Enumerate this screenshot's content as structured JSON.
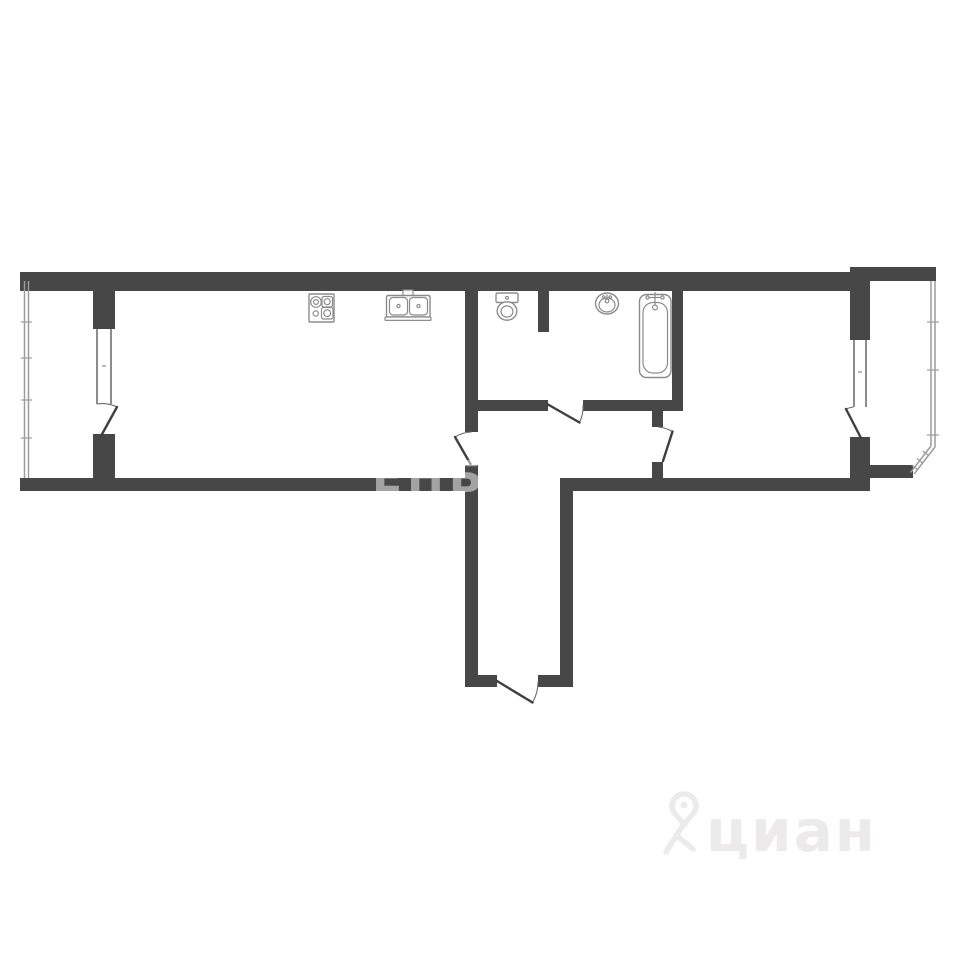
{
  "colors": {
    "background": "#ffffff",
    "wall_color": "#474747",
    "window_color": "#6f6f6f",
    "glazing_color": "#9c9c9c",
    "door_color": "#3f3f3f",
    "arc_color": "#6a6a6a",
    "fixture_color": "#8b8b8b",
    "wm_center_color": "rgba(255,255,255,0.5)",
    "wm_brand_color": "#eceaea"
  },
  "watermark": {
    "center_text": "ЕНБ",
    "brand_text": "циан",
    "logo": "cian-pin-person-logo"
  },
  "floor_plan": {
    "type": "apartment-linear-floor-plan",
    "rooms": [
      "left-loggia",
      "kitchen-living-room",
      "bathroom-wc",
      "hallway",
      "entrance-corridor",
      "bedroom",
      "right-loggia-bay"
    ],
    "fixtures": [
      "stove-4-burner",
      "double-bowl-sink",
      "toilet",
      "washbasin",
      "bathtub"
    ],
    "doors": [
      "left-balcony-door",
      "kitchen-door",
      "bathroom-door",
      "bedroom-door",
      "right-balcony-door",
      "entrance-door"
    ],
    "windows": [
      "left-loggia-glazing",
      "left-balcony-window",
      "right-balcony-window",
      "right-loggia-glazing",
      "right-loggia-corner-glazing"
    ]
  }
}
